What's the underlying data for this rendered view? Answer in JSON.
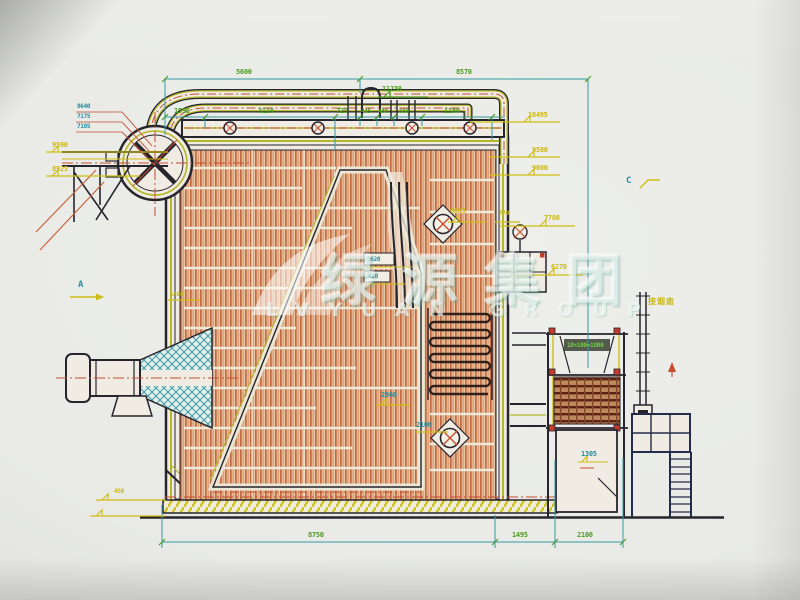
{
  "watermark": {
    "cn": "绿源集团",
    "en": "LVYUAN GROUP"
  },
  "dimensions": {
    "top": [
      "5600",
      "8570"
    ],
    "row2": [
      "1590",
      "3110",
      "725",
      "445",
      "480",
      "680",
      "1180"
    ],
    "bottom": [
      "8750",
      "1495",
      "2100"
    ]
  },
  "elevations": {
    "top_center": "11230",
    "right": [
      "10495",
      "9580",
      "9080",
      "7708",
      "6270"
    ],
    "left": [
      "9590",
      "8925"
    ],
    "left_stack": [
      "8640",
      "7175",
      "7105"
    ],
    "mid": {
      "m770": "770",
      "m8603": "8603",
      "m2960": "2960",
      "m2108": "2108",
      "m1305": "1305",
      "m450": "450",
      "m1480": "1480"
    }
  },
  "component_labels": {
    "header_box_top": "5620",
    "header_box_bottom": "610",
    "economizer_rows": "18×100=1800",
    "chimney_note": "接烟囱"
  },
  "section_markers": {
    "a": "A",
    "c": "C"
  },
  "colors": {
    "paper": "#e9eae6",
    "line_dark": "#26242e",
    "dim_line": "#2e9aa6",
    "dim_text_green": "#4b9c1c",
    "elev_text_yellow": "#cdb90a",
    "label_cyan": "#1d8fa6",
    "centerline_red": "#cc4a2e",
    "tube_orange": "#c8693c",
    "casing_green": "#b5b822"
  }
}
